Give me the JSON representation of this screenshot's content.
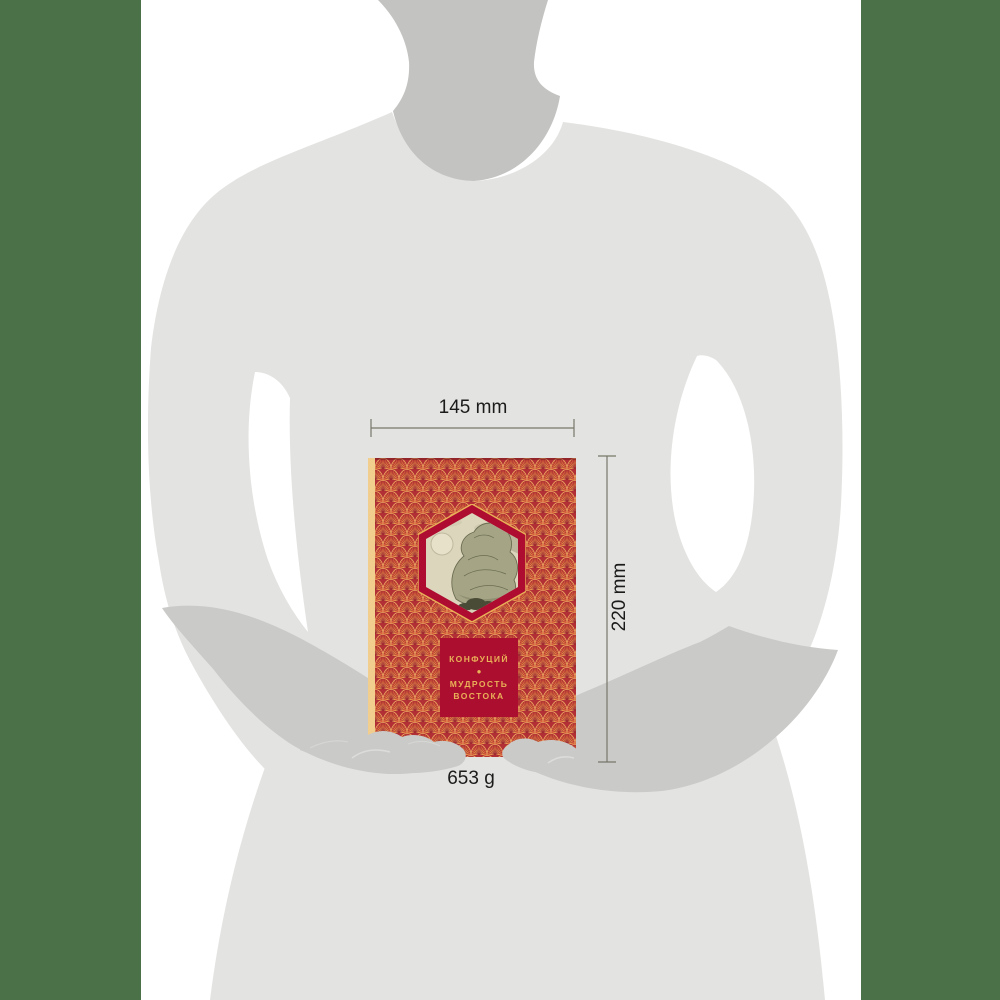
{
  "book": {
    "author": "КОНФУЦИЙ",
    "separator_glyph": "●",
    "title_line1": "МУДРОСТЬ",
    "title_line2": "ВОСТОКА"
  },
  "dimensions": {
    "width_label": "145 mm",
    "height_label": "220 mm",
    "weight_label": "653 g"
  },
  "colors": {
    "side_panel_green": "#4a7148",
    "background": "#ffffff",
    "silhouette_body": "#e3e3e1",
    "silhouette_neck": "#c3c3c1",
    "silhouette_forearm": "#cacac8",
    "cover_red": "#b22f35",
    "fan_gold": "#f0b264",
    "spine_cream": "#f1cd8e",
    "emblem_crimson": "#ab0e2f",
    "emblem_border": "#ae0c30",
    "title_gold": "#e9b158",
    "landscape_beige": "#dcd6bd",
    "dimension_line": "#77776b",
    "label_text": "#1b1b1b"
  },
  "icons": {
    "hexagon_emblem": "hexagon-landscape-window",
    "dot_separator": "circle-dot"
  }
}
